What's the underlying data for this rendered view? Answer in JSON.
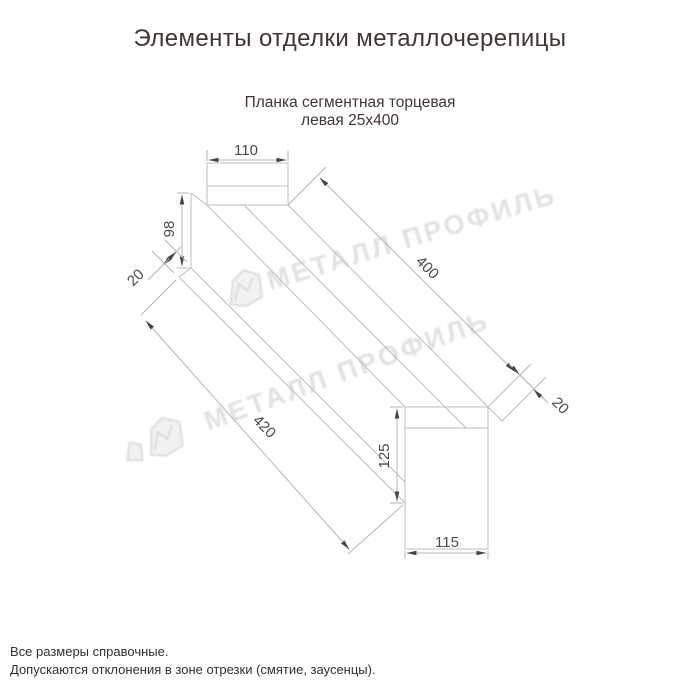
{
  "header": {
    "title": "Элементы отделки металлочерепицы"
  },
  "product": {
    "name_line1": "Планка сегментная торцевая",
    "name_line2": "левая 25х400"
  },
  "dimensions": {
    "top_flange_width": "110",
    "side_height": "98",
    "left_hem": "20",
    "length": "400",
    "right_hem": "20",
    "total_length": "420",
    "end_cap_height": "125",
    "end_cap_width": "115"
  },
  "watermark": {
    "text": "МЕТАЛЛ ПРОФИЛЬ"
  },
  "footer": {
    "line1": "Все размеры справочные.",
    "line2": "Допускаются отклонения в зоне отрезки (смятие, заусенцы)."
  },
  "colors": {
    "background": "#ffffff",
    "title_text": "#3f3533",
    "dimension_text": "#4a4a4a",
    "drawing_line": "#bcbcbc",
    "arrow": "#444444",
    "watermark": "#e2e2e2"
  }
}
